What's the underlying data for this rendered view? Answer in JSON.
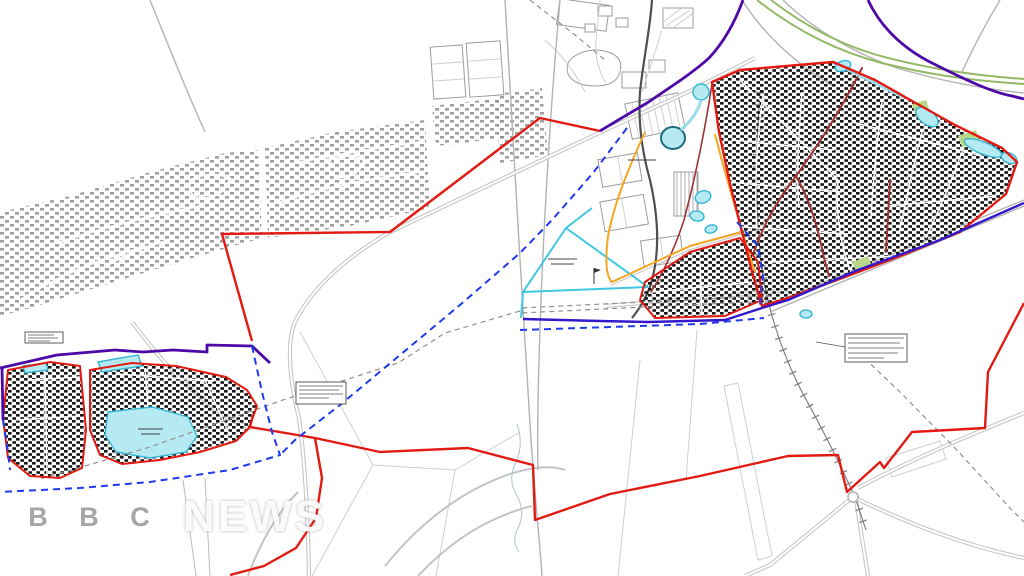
{
  "watermark": {
    "boxes": [
      "B",
      "B",
      "C"
    ],
    "word": "NEWS"
  },
  "map": {
    "colors": {
      "background": "#ffffff",
      "red": "#e21a12",
      "maroon": "#9e3434",
      "purple": "#4d09a8",
      "indigo": "#3318cc",
      "bluedash": "#1f3bee",
      "cyan": "#3fc6e0",
      "water_fill": "#b5eaf2",
      "water_stroke": "#35b6d4",
      "orange": "#f5a623",
      "green": "#93b966",
      "lime": "#b8d98a",
      "darkroad": "#4f4f4f",
      "grey_housing": "#8f8f8f",
      "black_housing": "#161616"
    },
    "annotations": [
      {
        "name": "notice-existing-housing",
        "legible": false,
        "lines": 3
      },
      {
        "name": "notice-centre-left",
        "legible": false,
        "lines": 4
      },
      {
        "name": "notice-railway-right",
        "legible": false,
        "lines": 5
      },
      {
        "name": "lake-label",
        "legible": false,
        "lines": 2
      },
      {
        "name": "local-centre-label",
        "legible": false,
        "lines": 1
      },
      {
        "name": "open-space-label",
        "legible": false,
        "lines": 2
      }
    ]
  }
}
